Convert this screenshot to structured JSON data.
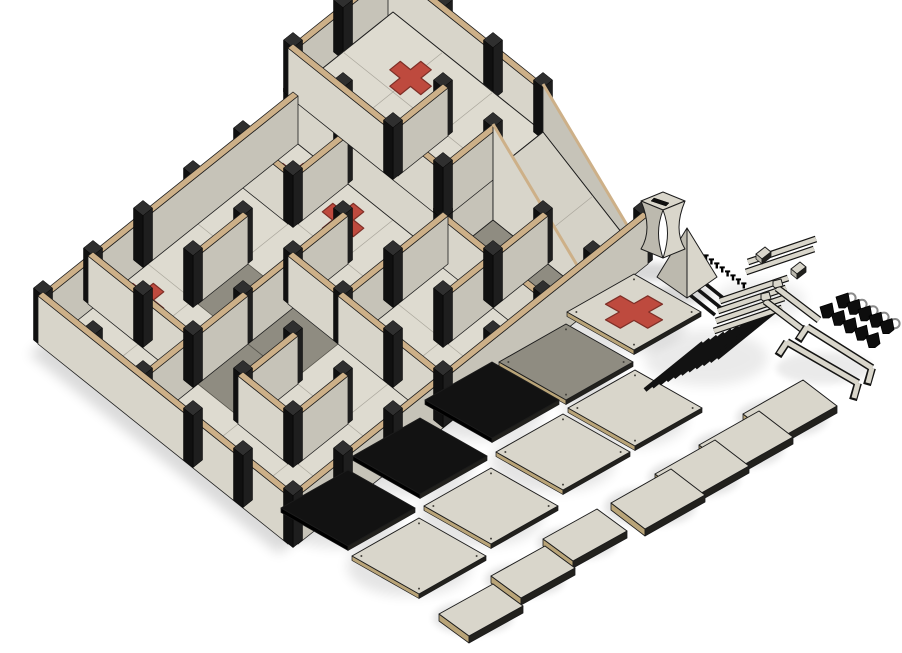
{
  "meta": {
    "view": "isometric-3d-render",
    "background": "#ffffff"
  },
  "palette": {
    "floor": "#dedbd0",
    "floor_line": "#a9a69b",
    "outline": "#1c1c1c",
    "gray_tile": "#8f8c81",
    "wall_face_h": "#d8d5ca",
    "wall_face_v": "#c6c3b8",
    "wall_top": "#cdb088",
    "post": "#101010",
    "post_top": "#2f2f2f",
    "post_side": "#1e1e1e",
    "red": "#be4a3e",
    "red_stroke": "#7e2f27",
    "ramp": "#d5d2c7",
    "part_cream": "#d9d6cb",
    "part_cream_dark": "#bcb9ae",
    "part_tan": "#b9a478",
    "part_black": "#121212",
    "part_edge_dark": "#22211d",
    "ring": "#8a8a8a",
    "shadow": "#000000"
  },
  "board": {
    "origin": [
      393,
      60
    ],
    "u": [
      50,
      40
    ],
    "v": [
      -50,
      40
    ],
    "cols": 5,
    "rows": 7,
    "wall_height": 48,
    "wall_thickness": 0.1,
    "post_size": 0.095,
    "gray_tiles": [
      [
        3,
        1
      ],
      [
        4,
        1
      ],
      [
        1,
        4
      ],
      [
        2,
        4
      ],
      [
        2,
        5
      ]
    ],
    "crosses": [
      {
        "c": [
          1.5,
          2.5
        ]
      },
      {
        "c": [
          0.5,
          2.5
        ]
      },
      {
        "c": [
          0.5,
          5.5
        ]
      }
    ],
    "cross_arm": 0.62,
    "cross_width": 0.21,
    "walls": [
      {
        "dir": "v",
        "x": 0,
        "y": 2,
        "len": 5
      },
      {
        "dir": "h",
        "y": 7,
        "x": 0,
        "len": 5
      },
      {
        "dir": "v",
        "x": 5,
        "y": 0,
        "len": 7
      },
      {
        "dir": "h",
        "y": 3,
        "x": 0,
        "len": 1
      },
      {
        "dir": "v",
        "x": 1,
        "y": 2,
        "len": 1
      },
      {
        "dir": "h",
        "y": 2,
        "x": 3,
        "len": 2
      },
      {
        "dir": "v",
        "x": 2,
        "y": 3,
        "len": 2
      },
      {
        "dir": "h",
        "y": 4,
        "x": 2,
        "len": 1
      },
      {
        "dir": "v",
        "x": 3,
        "y": 2,
        "len": 2
      },
      {
        "dir": "h",
        "y": 6,
        "x": 0,
        "len": 2
      },
      {
        "dir": "v",
        "x": 1,
        "y": 4,
        "len": 1
      },
      {
        "dir": "v",
        "x": 4,
        "y": 1,
        "len": 2
      },
      {
        "dir": "h",
        "y": 4,
        "x": 3,
        "len": 2
      },
      {
        "dir": "v",
        "x": 2,
        "y": 5,
        "len": 2
      },
      {
        "dir": "h",
        "y": 6,
        "x": 3,
        "len": 1
      },
      {
        "dir": "v",
        "x": 3,
        "y": 5,
        "len": 1
      },
      {
        "dir": "v",
        "x": 4,
        "y": 5,
        "len": 1
      }
    ]
  },
  "platform": {
    "x0": 0,
    "y0": 0,
    "x1": 3,
    "y1": 2,
    "z": 48,
    "cross": [
      1.0,
      0.65
    ],
    "walls": [
      {
        "dir": "h",
        "y": 0,
        "x": 0,
        "len": 3
      },
      {
        "dir": "v",
        "x": 0,
        "y": 0,
        "len": 2
      },
      {
        "dir": "h",
        "y": 2,
        "x": 0,
        "len": 3
      },
      {
        "dir": "v",
        "x": 2,
        "y": 1,
        "len": 1
      },
      {
        "dir": "v",
        "x": 3,
        "y": 1,
        "len": 1
      }
    ]
  },
  "ramp": {
    "x0": 3,
    "x1": 5,
    "y0": 0,
    "y1": 1,
    "z_top": 48,
    "parapet": 48,
    "toe": 8
  },
  "parts": {
    "tiles": [
      {
        "c": [
          634,
          312
        ],
        "kind": "cross"
      },
      {
        "c": [
          566,
          362
        ],
        "kind": "gray"
      },
      {
        "c": [
          492,
          400
        ],
        "kind": "black"
      },
      {
        "c": [
          420,
          456
        ],
        "kind": "black"
      },
      {
        "c": [
          348,
          508
        ],
        "kind": "black"
      },
      {
        "c": [
          635,
          408
        ],
        "kind": "cream"
      },
      {
        "c": [
          563,
          452
        ],
        "kind": "cream"
      },
      {
        "c": [
          491,
          506
        ],
        "kind": "cream"
      },
      {
        "c": [
          419,
          556
        ],
        "kind": "cream"
      }
    ],
    "tile_rx": 67,
    "tile_ry": 38,
    "panels_large": [
      [
        790,
        410
      ],
      [
        746,
        441
      ],
      [
        702,
        470
      ],
      [
        658,
        499
      ]
    ],
    "panels_small": [
      [
        585,
        535
      ],
      [
        533,
        572
      ],
      [
        481,
        610
      ]
    ],
    "rod_stack": {
      "start": [
        645,
        390
      ],
      "n": 11,
      "step": [
        7.2,
        -3.2
      ],
      "dir": [
        58,
        -47
      ],
      "w": 4.5
    },
    "rods_small": {
      "start": [
        697,
        277
      ],
      "n": 3,
      "step": [
        -6,
        7
      ],
      "dir": [
        30,
        24
      ],
      "w": 3.6
    },
    "pegs": {
      "start": [
        706,
        258
      ],
      "n": 8,
      "step": [
        5.4,
        4.0
      ]
    },
    "rails_long": {
      "start": [
        714,
        331
      ],
      "n": 4,
      "step": [
        2,
        -10
      ],
      "dir": [
        68,
        -23
      ],
      "w": 4.4
    },
    "rails_upper": {
      "start": [
        748,
        262
      ],
      "n": 2,
      "step": [
        -2,
        10
      ],
      "dir": [
        68,
        -23
      ],
      "w": 4.4,
      "blocks": [
        [
          763,
          251
        ],
        [
          798,
          266
        ]
      ]
    },
    "step_bars": {
      "start": [
        777,
        288
      ],
      "n": 2,
      "step": [
        -12,
        13
      ],
      "dir": [
        42,
        32
      ],
      "w": 5
    },
    "clip_rows": [
      {
        "start": [
          843,
          301
        ],
        "n": 5,
        "step": [
          11,
          6.4
        ],
        "ring": true
      },
      {
        "start": [
          827,
          311
        ],
        "n": 5,
        "step": [
          11.5,
          7.4
        ],
        "ring": false
      }
    ],
    "handles": [
      {
        "a": [
          807,
          327
        ],
        "b": [
          872,
          368
        ]
      },
      {
        "a": [
          787,
          342
        ],
        "b": [
          858,
          383
        ]
      }
    ],
    "pyramid": {
      "apex": [
        687,
        228
      ],
      "base_c": [
        687,
        277
      ],
      "rx": 30,
      "ry": 21
    },
    "column": {
      "c": [
        663,
        233
      ]
    }
  }
}
